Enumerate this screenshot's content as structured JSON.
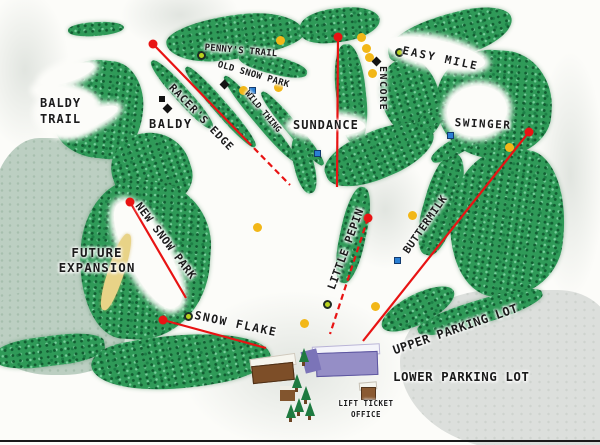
{
  "map": {
    "region_labels": {
      "baldy_trail": "BALDY\nTRAIL",
      "baldy": "BALDY",
      "pennys_trail": "PENNY'S TRAIL",
      "old_snow_park": "OLD SNOW PARK",
      "racers_edge": "RACER'S EDGE",
      "wild_thing": "WILD THING",
      "sundance": "SUNDANCE",
      "encore": "ENCORE",
      "easy_mile": "EASY MILE",
      "swinger": "SWINGER",
      "buttermilk": "BUTTERMILK",
      "little_pepin": "LITTLE PEPIN",
      "new_snow_park": "NEW SNOW PARK",
      "future_expansion": "FUTURE\nEXPANSION",
      "snow_flake": "SNOW FLAKE",
      "upper_parking_lot": "UPPER PARKING LOT",
      "lower_parking_lot": "LOWER PARKING LOT",
      "lift_ticket_office": "LIFT TICKET\nOFFICE"
    },
    "lifts": [
      {
        "name": "racers-edge-lift",
        "segments": [
          {
            "x1": 153,
            "y1": 44,
            "x2": 247,
            "y2": 141,
            "dashed": false
          },
          {
            "x1": 247,
            "y1": 141,
            "x2": 290,
            "y2": 185,
            "dashed": true
          }
        ],
        "dot": {
          "x": 153,
          "y": 44
        }
      },
      {
        "name": "sundance-lift",
        "segments": [
          {
            "x1": 338,
            "y1": 37,
            "x2": 337,
            "y2": 187,
            "dashed": false
          }
        ],
        "dot": {
          "x": 338,
          "y": 37
        }
      },
      {
        "name": "swinger-lift",
        "segments": [
          {
            "x1": 529,
            "y1": 132,
            "x2": 363,
            "y2": 341,
            "dashed": false
          }
        ],
        "dot": {
          "x": 529,
          "y": 132
        }
      },
      {
        "name": "little-pepin-lift",
        "segments": [
          {
            "x1": 368,
            "y1": 218,
            "x2": 330,
            "y2": 334,
            "dashed": true
          }
        ],
        "dot": {
          "x": 368,
          "y": 218
        }
      },
      {
        "name": "new-snow-park-lift",
        "segments": [
          {
            "x1": 130,
            "y1": 202,
            "x2": 186,
            "y2": 298,
            "dashed": false
          }
        ],
        "dot": {
          "x": 130,
          "y": 202
        }
      },
      {
        "name": "snow-flake-lift",
        "segments": [
          {
            "x1": 163,
            "y1": 320,
            "x2": 266,
            "y2": 348,
            "dashed": false
          }
        ],
        "dot": {
          "x": 163,
          "y": 320
        }
      }
    ],
    "markers": {
      "yellow_dots": [
        [
          280,
          40
        ],
        [
          361,
          37
        ],
        [
          366,
          48
        ],
        [
          369,
          57
        ],
        [
          372,
          73
        ],
        [
          278,
          87
        ],
        [
          243,
          90
        ],
        [
          257,
          227
        ],
        [
          412,
          215
        ],
        [
          509,
          147
        ],
        [
          375,
          306
        ],
        [
          304,
          323
        ]
      ],
      "green_circles": [
        [
          201,
          55
        ],
        [
          399,
          52
        ],
        [
          188,
          316
        ],
        [
          327,
          304
        ]
      ],
      "blue_squares": [
        [
          252,
          90
        ],
        [
          317,
          153
        ],
        [
          450,
          135
        ],
        [
          397,
          260
        ]
      ],
      "black_diamonds": [
        [
          224,
          84
        ],
        [
          376,
          61
        ],
        [
          167,
          108
        ]
      ],
      "black_squares": [
        [
          162,
          99
        ]
      ]
    },
    "colors": {
      "forest_green": "#2f9a58",
      "forest_dark": "#115c31",
      "sage_area": "#bccfc2",
      "parking_gray": "#dcdfdc",
      "lift_red": "#e81313",
      "marker_yellow": "#f2b718",
      "marker_blue": "#2a7fd4",
      "marker_green": "#b9d21f",
      "marker_black": "#131313",
      "text_black": "#1b1b1b",
      "lodge_brown": "#7d4e28",
      "lodge_purple": "#958ec6"
    }
  }
}
